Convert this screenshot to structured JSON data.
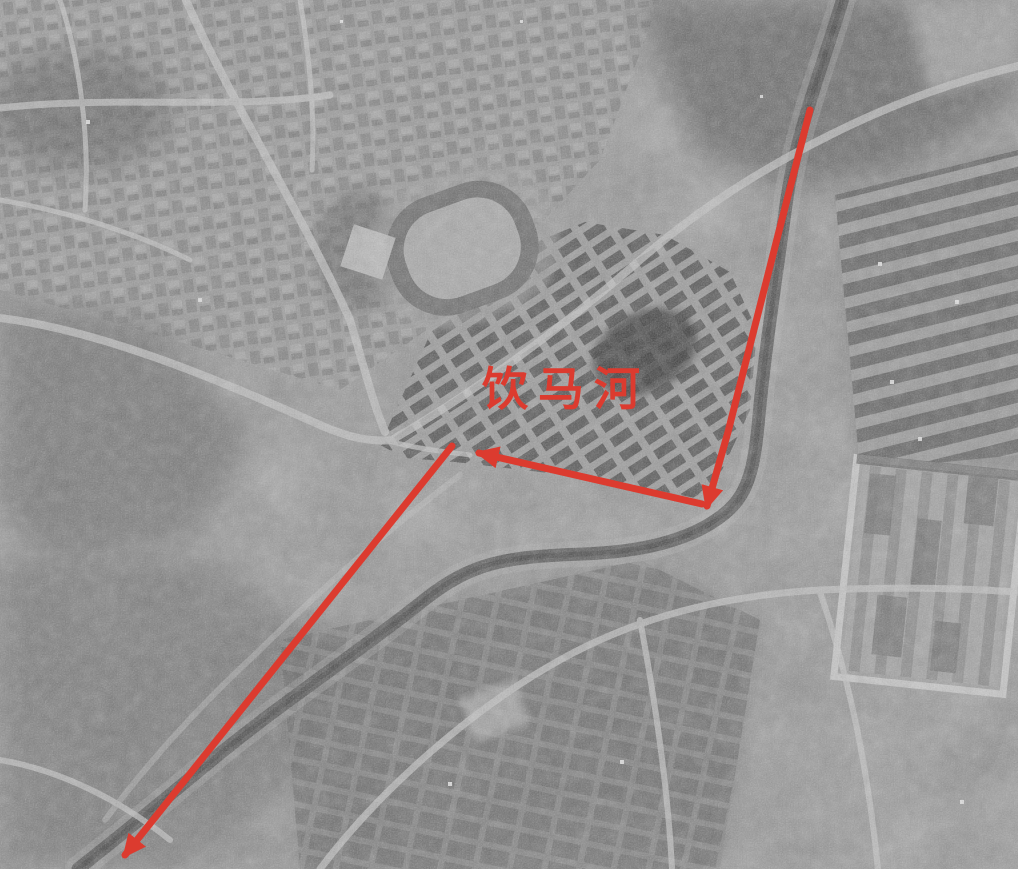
{
  "annotation": {
    "color": "#dc3b2f",
    "stroke_width": 7,
    "label": {
      "text": "饮马河",
      "x": 566,
      "y": 389,
      "font_size": 46,
      "letter_spacing": 10
    },
    "arrows": [
      {
        "name": "river-course-arrow-north",
        "points": [
          [
            810,
            110
          ],
          [
            778,
            235
          ],
          [
            728,
            432
          ],
          [
            707,
            506
          ]
        ]
      },
      {
        "name": "river-course-arrow-middle",
        "points": [
          [
            702,
            504
          ],
          [
            479,
            453
          ]
        ]
      },
      {
        "name": "river-course-arrow-south",
        "points": [
          [
            452,
            446
          ],
          [
            125,
            855
          ]
        ]
      }
    ]
  }
}
